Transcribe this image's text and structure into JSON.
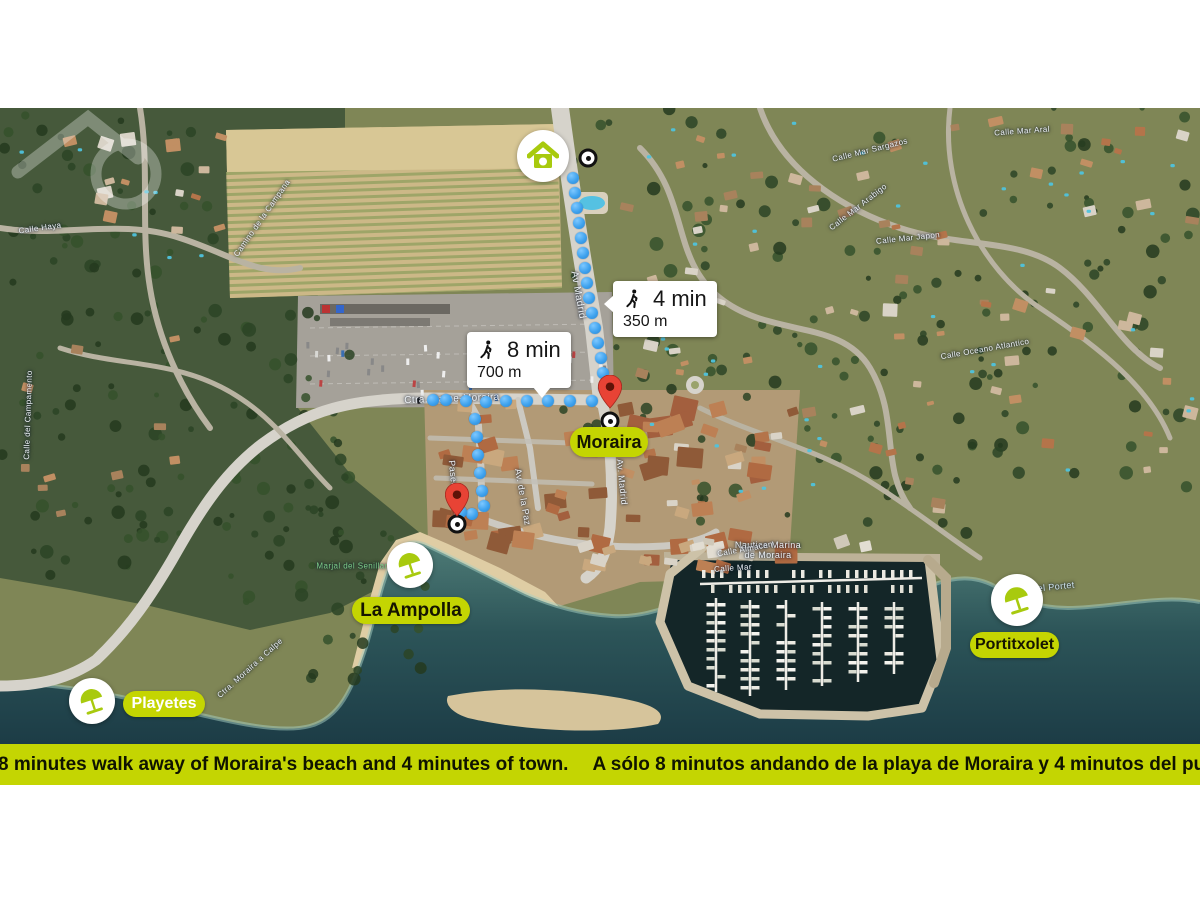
{
  "banner": {
    "text_en": "Only 8 minutes walk away of Moraira's beach and 4 minutes of town.",
    "text_es": "A sólo 8 minutos andando de la playa de Moraira y 4 minutos del pueblo."
  },
  "callouts": {
    "town": {
      "time": "4 min",
      "distance": "350 m"
    },
    "beach": {
      "time": "8 min",
      "distance": "700 m"
    }
  },
  "places": {
    "moraira": "Moraira",
    "la_ampolla": "La Ampolla",
    "playetes": "Playetes",
    "portitxolet": "Portitxolet"
  },
  "colors": {
    "brand_lime": "#c4d502",
    "icon_lime": "#a8ca0e",
    "route_blue": "#3ea2ee",
    "pin_red": "#e84335"
  },
  "icons": [
    "home-icon",
    "beach-umbrella-icon",
    "walking-person-icon",
    "map-pin-icon",
    "route-endpoint-icon",
    "logo-watermark"
  ],
  "map": {
    "street_labels": [
      {
        "text": "Av Madrid",
        "x": 578,
        "y": 295,
        "rot": 80,
        "size": 10
      },
      {
        "text": "Av. Madrid",
        "x": 622,
        "y": 482,
        "rot": 84,
        "size": 9
      },
      {
        "text": "Ctra. Calpe-Moraira",
        "x": 452,
        "y": 399,
        "rot": -2,
        "size": 10
      },
      {
        "text": "Paseo Senillar",
        "x": 455,
        "y": 492,
        "rot": 84,
        "size": 9
      },
      {
        "text": "Av. de la Paz",
        "x": 523,
        "y": 497,
        "rot": 80,
        "size": 9
      },
      {
        "text": "Nautica Marina\nde Moraira",
        "x": 768,
        "y": 550,
        "rot": 0,
        "size": 9
      },
      {
        "text": "Calle Almacen",
        "x": 745,
        "y": 549,
        "rot": -10,
        "size": 8
      },
      {
        "text": "Calle Mar",
        "x": 733,
        "y": 568,
        "rot": -4,
        "size": 8
      },
      {
        "text": "Calle Mar Sargazos",
        "x": 870,
        "y": 150,
        "rot": -14,
        "size": 8
      },
      {
        "text": "Calle Mar Aral",
        "x": 1022,
        "y": 131,
        "rot": -4,
        "size": 8
      },
      {
        "text": "Calle Mar Arabigo",
        "x": 858,
        "y": 207,
        "rot": -38,
        "size": 8
      },
      {
        "text": "Calle Mar Japon",
        "x": 908,
        "y": 238,
        "rot": -6,
        "size": 8
      },
      {
        "text": "Camino de la Campana",
        "x": 262,
        "y": 218,
        "rot": -55,
        "size": 8
      },
      {
        "text": "Calle Haya",
        "x": 40,
        "y": 228,
        "rot": -8,
        "size": 8
      },
      {
        "text": "Calle del Campamento",
        "x": 28,
        "y": 415,
        "rot": -88,
        "size": 8
      },
      {
        "text": "Ctra. Moraira a Calpe",
        "x": 250,
        "y": 668,
        "rot": -42,
        "size": 8
      },
      {
        "text": "Calle Oceano Atlantico",
        "x": 985,
        "y": 349,
        "rot": -10,
        "size": 8
      },
      {
        "text": "Cala del Portet",
        "x": 1042,
        "y": 588,
        "rot": -6,
        "size": 9,
        "color": "#cfe3ee"
      },
      {
        "text": "Marjal del Senillar",
        "x": 352,
        "y": 566,
        "rot": 0,
        "size": 8,
        "color": "#7fd18a"
      }
    ],
    "routes": {
      "town": [
        [
          573,
          178
        ],
        [
          575,
          193
        ],
        [
          577,
          208
        ],
        [
          579,
          223
        ],
        [
          581,
          238
        ],
        [
          583,
          253
        ],
        [
          585,
          268
        ],
        [
          587,
          283
        ],
        [
          589,
          298
        ],
        [
          592,
          313
        ],
        [
          595,
          328
        ],
        [
          598,
          343
        ],
        [
          601,
          358
        ],
        [
          603,
          373
        ],
        [
          604,
          388
        ]
      ],
      "beach": [
        [
          592,
          401
        ],
        [
          570,
          401
        ],
        [
          548,
          401
        ],
        [
          527,
          401
        ],
        [
          506,
          401
        ],
        [
          486,
          402
        ],
        [
          466,
          401
        ],
        [
          446,
          400
        ],
        [
          433,
          400
        ],
        [
          475,
          419
        ],
        [
          477,
          437
        ],
        [
          478,
          455
        ],
        [
          480,
          473
        ],
        [
          482,
          491
        ],
        [
          484,
          506
        ],
        [
          472,
          514
        ],
        [
          461,
          512
        ]
      ]
    },
    "markers": {
      "home": {
        "x": 543,
        "y": 156
      },
      "origin_ring": {
        "x": 588,
        "y": 158
      },
      "pin_town": {
        "x": 610,
        "y": 409
      },
      "ring_town": {
        "x": 610,
        "y": 421
      },
      "pin_beach": {
        "x": 457,
        "y": 517
      },
      "ring_beach": {
        "x": 457,
        "y": 524
      },
      "umb_ampolla": {
        "x": 410,
        "y": 565
      },
      "umb_playetes": {
        "x": 92,
        "y": 701
      },
      "umb_portitxolet": {
        "x": 1017,
        "y": 600
      }
    }
  }
}
